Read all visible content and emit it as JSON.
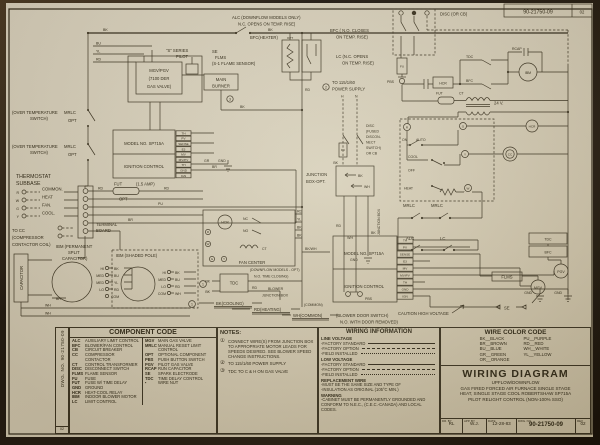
{
  "sheet": {
    "stamp_top_no": "90-21750-09",
    "stamp_top_rev": "02"
  },
  "schematic": {
    "ic_terminals": [
      "TH",
      "PV",
      "SENSE",
      "E3",
      "MV",
      "MV/PV",
      "TH",
      "GND",
      "IGN"
    ],
    "labels": {
      "bk": "BK",
      "bu": "BU",
      "yl": "YL",
      "rd": "RD",
      "wh": "WH",
      "br": "BR",
      "pu": "PU",
      "gr": "GR",
      "bkwh": "BK/WH",
      "ovt1": "(OVER TEMPERATURE",
      "ovt2": "SWITCH)",
      "mrlc": "MRLC",
      "opt": "OPT",
      "thermostat1": "THERMOSTAT",
      "thermostat2": "SUBBASE",
      "r": "R",
      "w": "W",
      "g": "G",
      "y": "Y",
      "common": "COMMON.",
      "heat": "HEAT",
      "fan": "FAN.",
      "cool": "COOL.",
      "tocc1": "TO CC",
      "tocc2": "(COMPRESSOR",
      "tocc3": "CONTACTOR COIL)",
      "tb1": "TERMINAL",
      "tb2": "BOARD",
      "capacitor": "CAPACITOR",
      "ibmpsc1": "IBM (PERMANENT",
      "ibmpsc2": "SPLIT",
      "ibmpsc3": "CAPACITOR)",
      "ibmsp": "IBM (SHADED POLE)",
      "hi": "HI",
      "med": "MED",
      "lo": "LO",
      "com": "COM",
      "mgvpgv": "MGV/PGV",
      "der1": "(7100 DER",
      "der2": "GAS VALVE)",
      "sseries": "\"S\" SERIES",
      "pilot": "PILOT",
      "se": "SE",
      "flms": "FLMS",
      "s1sensor": "(S-1 FLAME SENSOR)",
      "mainburner1": "MAIN",
      "mainburner2": "BURNER",
      "alcnote1": "ALC (DOWNFLOW MODELS ONLY)",
      "alcnote2": "N.C. OPENS ON TEMP. RISE)",
      "bfcheater": "BFC(HEATER)",
      "bfcno1": "BFC ( N.O. CLOSES",
      "bfcno2": "ON TEMP. RISE)",
      "lcnote1": "LC (N.C. OPENS",
      "lcnote2": "ON TEMP. RISE)",
      "pwr1": "TO 115/1/60",
      "pwr2": "POWER SUPPLY",
      "h": "H",
      "n": "N",
      "disc1": "DISC",
      "disc2": "(FUSED",
      "disc3": "DISCON-",
      "disc4": "NECT",
      "disc5": "SWITCH)",
      "disc6": "OR CB",
      "disccb": "DISC (OR CB)",
      "fu": "FU",
      "pbs": "PBS",
      "hcr": "HCR",
      "tdc": "TDC",
      "bfc": "BFC",
      "rcap": "RCAP",
      "ibm": "IBM",
      "cc": "CC",
      "fut": "FUT",
      "amp": "(1.5 AMP)",
      "ct": "CT",
      "v24": "24 V.",
      "model": "MODEL NO. SP715A",
      "ignition": "IGNITION CONTROL",
      "gnd": "GND",
      "fancenter": "FAN CENTER",
      "nc": "NC",
      "no": "NO",
      "on": "ON",
      "auto": "AUTO",
      "coolsw": "COOL",
      "off": "OFF",
      "heatsw": "HEAT",
      "alc": "ALC",
      "lc": "LC",
      "jb1": "JUNCTION",
      "jb2": "BOX-OPT.",
      "jbox": "JUNCTION BOX",
      "blower1": "BLOWER",
      "blower2": "JUNCTION BOX",
      "tdcnote1": "(DOWNFLOW MODELS - OPT)",
      "tdcnote2": "N.O. TIME CLOSING)",
      "bkcooling": "BK(COOLING)",
      "rdheating": "RD(HEATING)",
      "whcommon": "WH(COMMON)",
      "bds1": "(BLOWER DOOR SWITCH)",
      "bds2": "N.O. WITH DOOR REMOVED)",
      "commonlbl": "(COMMON)",
      "caution": "CAUTION HIGH VOLTAGE",
      "mgv": "MGV",
      "pgv": "PGV",
      "n1": "1",
      "n2": "2",
      "n3": "3"
    }
  },
  "side_strip": {
    "dwg": "DWG. NO. 90-21750-09",
    "rev": "02"
  },
  "component_code": {
    "title": "COMPONENT CODE",
    "left": [
      {
        "a": "ALC",
        "d": "AUXILIARY LIMIT CONTROL"
      },
      {
        "a": "BFC",
        "d": "BLOWER/FAN CONTROL"
      },
      {
        "a": "CB",
        "d": "CIRCUIT BREAKER"
      },
      {
        "a": "CC",
        "d": "COMPRESSOR CONTACTOR"
      },
      {
        "a": "CT",
        "d": "CONTROL TRANSFORMER"
      },
      {
        "a": "DISC",
        "d": "DISCONNECT SWITCH"
      },
      {
        "a": "FLMS",
        "d": "FLAME SENSOR"
      },
      {
        "a": "FU",
        "d": "FUSE"
      },
      {
        "a": "FUT",
        "d": "FUSE W/ TIME DELAY"
      },
      {
        "a": "GND",
        "d": "GROUND"
      },
      {
        "a": "HCR",
        "d": "HEAT-COOL RELAY"
      },
      {
        "a": "IBM",
        "d": "INDOOR BLOWER MOTOR"
      },
      {
        "a": "LC",
        "d": "LIMIT CONTROL"
      }
    ],
    "right": [
      {
        "a": "MGV",
        "d": "MAIN GAS VALVE"
      },
      {
        "a": "MRLC",
        "d": "MANUAL RESET LIMIT CONTROL"
      },
      {
        "a": "OPT",
        "d": "OPTIONAL COMPONENT"
      },
      {
        "a": "PBS",
        "d": "PUSH BUTTON SWITCH"
      },
      {
        "a": "PGV",
        "d": "PILOT GAS VALVE"
      },
      {
        "a": "RCAP",
        "d": "RUN CAPACITOR"
      },
      {
        "a": "SE",
        "d": "SPARK ELECTRODE"
      },
      {
        "a": "TDC",
        "d": "TIME DELAY CONTROL"
      },
      {
        "a": "▪",
        "d": "WIRE NUT"
      }
    ]
  },
  "notes": {
    "title": "NOTES:",
    "items": [
      {
        "n": "①",
        "t": "CONNECT WIRE(S) FROM JUNCTION BOX TO APPROPRIATE MOTOR LEADS FOR SPEEDS DESIRED. SEE BLOWER SPEED CHANGE INSTRUCTIONS."
      },
      {
        "n": "②",
        "t": "TO 115/1/60 POWER SUPPLY"
      },
      {
        "n": "③",
        "t": "TDC TO C & H ON GAS VALVE"
      }
    ]
  },
  "wiring_information": {
    "title": "WIRING INFORMATION",
    "line_voltage": "LINE VOLTAGE",
    "low_voltage": "LOW VOLTAGE",
    "factory_standard": "-FACTORY STANDARD",
    "factory_option": "-FACTORY OPTION",
    "field_installed": "-FIELD INSTALLED",
    "replacement": "REPLACEMENT WIRE",
    "rep1": "-MUST BE THE SAME SIZE AND TYPE OF",
    "rep2": "-INSULATION AS ORIGINAL (105°C MIN.)",
    "warning": "WARNING",
    "warn1": "-CABINET MUST BE PERMANENTLY GROUNDED AND CONFORM TO N.E.C., (C.E.C.-CANADA) AND LOCAL CODES."
  },
  "wire_color_code": {
    "title": "WIRE COLOR CODE",
    "left": [
      "BK__BLACK",
      "BR__BROWN",
      "BU__BLUE",
      "GR__GREEN",
      "OR__ORANGE"
    ],
    "right": [
      "PU__PURPLE",
      "RD__RED",
      "WH__WHITE",
      "YL__YELLOW"
    ]
  },
  "title_block": {
    "title": "WIRING DIAGRAM",
    "sub1": "UPFLOW/DOWNFLOW",
    "sub2": "GAS FIRED FORCED AIR FURNACE SINGLE STAGE",
    "sub3": "HEAT, SINGLE STAGE COOL ROBERTSHAW SP715A",
    "sub4": "PILOT RELIGHT CONTROL (NON-100% SSO)",
    "dr_by_label": "DR. BY",
    "dr_by": "RL",
    "app_by_label": "APP. BY",
    "app_by": "W.J.",
    "date_label": "DATE",
    "date": "12-28-83",
    "dwg_label": "DWG. NO.",
    "dwg_no": "90-21750-09",
    "rev_label": "REV",
    "rev": "02"
  }
}
